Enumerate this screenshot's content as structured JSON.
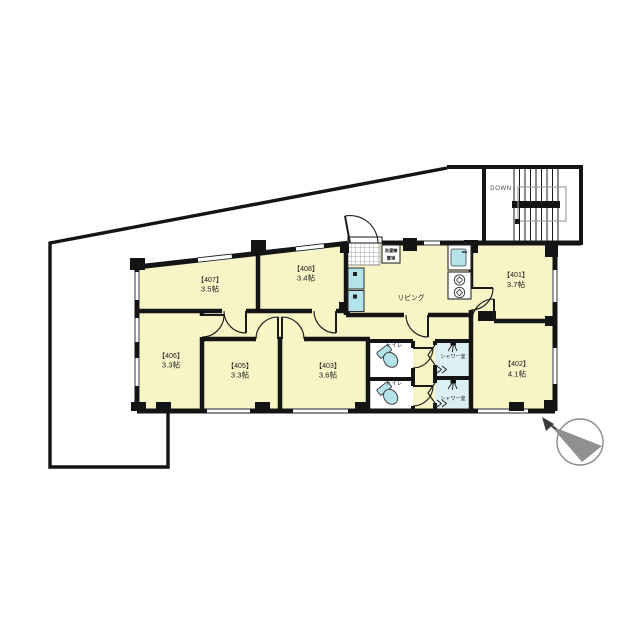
{
  "plan": {
    "rooms": {
      "r401": {
        "id": "【401】",
        "size": "3.7帖"
      },
      "r402": {
        "id": "【402】",
        "size": "4.1帖"
      },
      "r403": {
        "id": "【403】",
        "size": "3.6帖"
      },
      "r405": {
        "id": "【405】",
        "size": "3.3帖"
      },
      "r406": {
        "id": "【406】",
        "size": "3.3帖"
      },
      "r407": {
        "id": "【407】",
        "size": "3.5帖"
      },
      "r408": {
        "id": "【408】",
        "size": "3.4帖"
      }
    },
    "labels": {
      "living": "リビング",
      "toilet": "トイレ",
      "shower": "シャワー室",
      "stairs_down": "DOWN",
      "laundry_line1": "洗濯機",
      "laundry_line2": "置場"
    },
    "colors": {
      "floor": "#F7F4C6",
      "fixture": "#B5E3EA",
      "shower_floor": "#DCEFF2",
      "wall": "#141414",
      "compass": "#909090"
    }
  }
}
